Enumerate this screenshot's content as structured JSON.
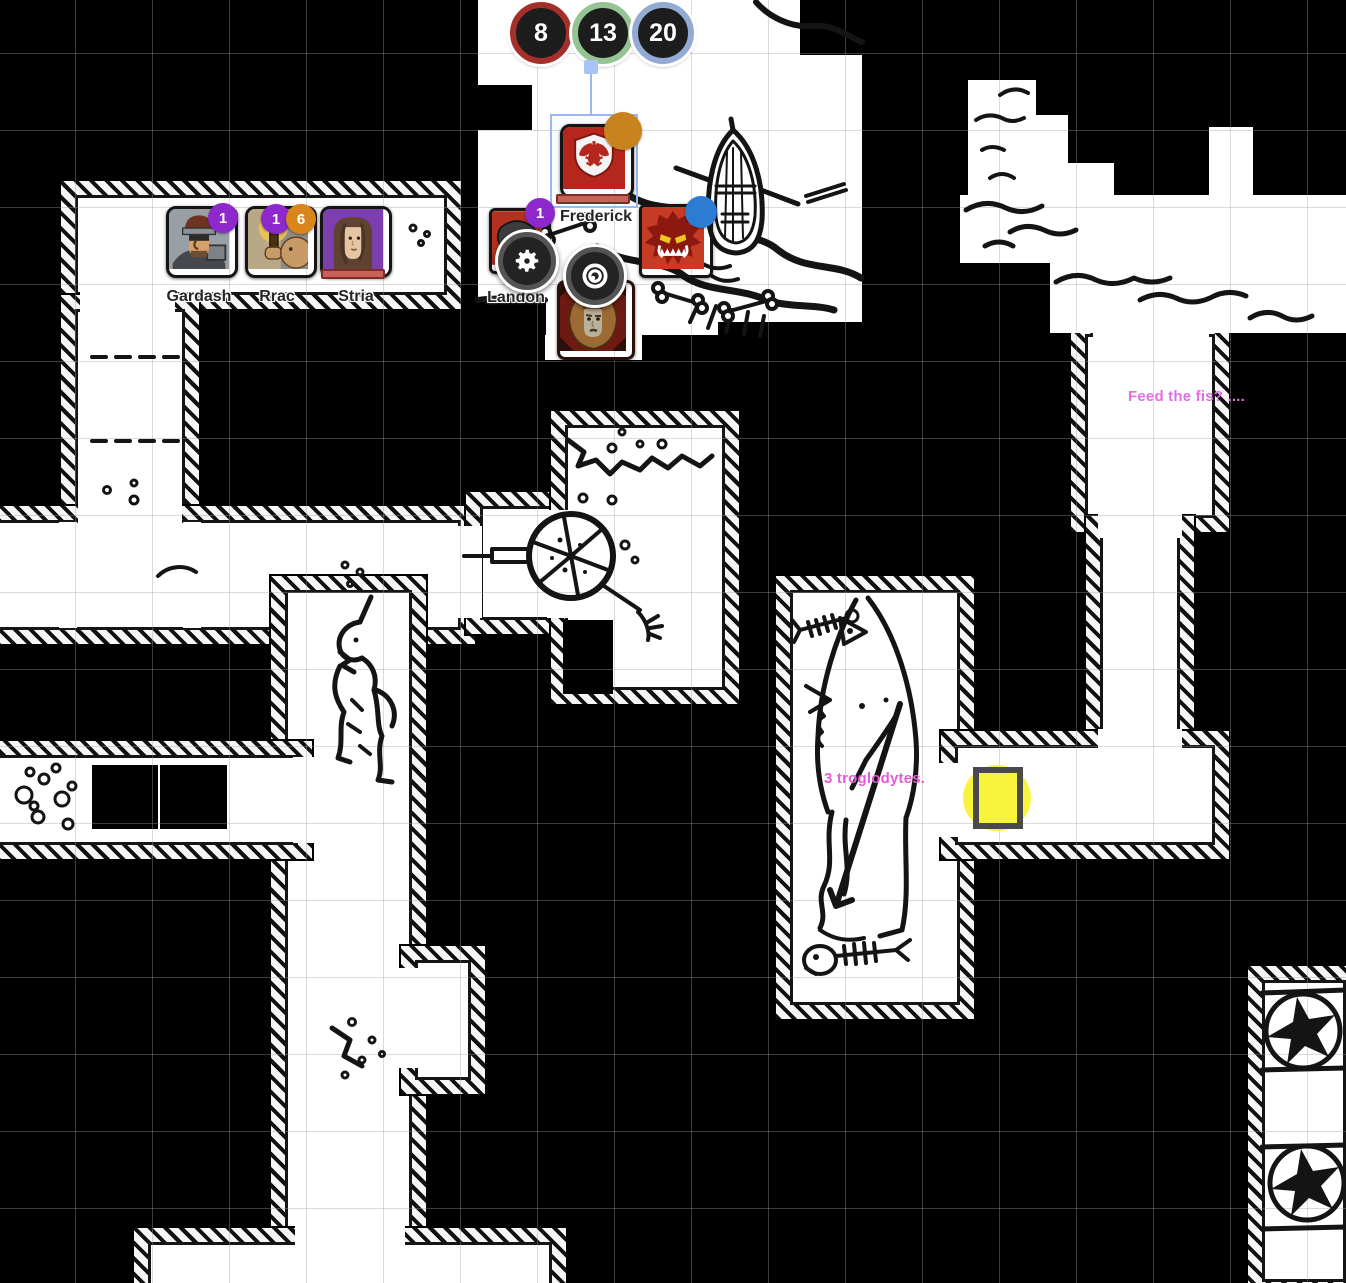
{
  "canvas": {
    "width": 1346,
    "height": 1283,
    "background": "#000000",
    "paper": "#ffffff",
    "map_ink": "#141414",
    "grid_color": "#9e9e9e"
  },
  "dice": {
    "results": [
      {
        "value": "8",
        "ring_color": "#a5302a"
      },
      {
        "value": "13",
        "ring_color": "#94c494"
      },
      {
        "value": "20",
        "ring_color": "#93abd2"
      }
    ]
  },
  "party": {
    "tokens": [
      {
        "label": "Gardash",
        "badges": [
          {
            "value": "1",
            "color": "#8d28cc"
          }
        ]
      },
      {
        "label": "Rrac",
        "badges": [
          {
            "value": "1",
            "color": "#8d28cc"
          },
          {
            "value": "6",
            "color": "#d8861c"
          }
        ]
      },
      {
        "label": "Stria",
        "badges": [],
        "health_bar_color": "#c96158"
      },
      {
        "label": "Landon",
        "badges": [
          {
            "value": "1",
            "color": "#8d28cc"
          }
        ]
      }
    ]
  },
  "selection": {
    "token_label": "Frederick",
    "box_color": "#9cb8f0",
    "status_dot_color": "#c8821e",
    "health_bar_color": "#c96158"
  },
  "npcs": [
    {
      "icon": "demon-face-token",
      "status_dot_color": "#2d7cd4"
    },
    {
      "icon": "lion-maned-man-token"
    }
  ],
  "context_menu": {
    "buttons": [
      {
        "icon": "gear-icon"
      },
      {
        "icon": "focus-icon"
      }
    ]
  },
  "annotations": [
    {
      "text": "Feed the fis? ....",
      "color": "#e46ee4"
    },
    {
      "text": "3 troglodytes.",
      "color": "#e85ad2"
    }
  ],
  "marker": {
    "name": "yellow-highlight-square",
    "fill": "#f8f43e",
    "border": "#4a4a4a"
  },
  "map_features": [
    "rowboat",
    "shoreline-water",
    "bones",
    "wagon-wheel",
    "cave-in-rubble",
    "wall-creature-sketch",
    "troglodyte-sketch",
    "fish-skeletons",
    "pebbles",
    "star-glyphs",
    "door-dashes"
  ]
}
